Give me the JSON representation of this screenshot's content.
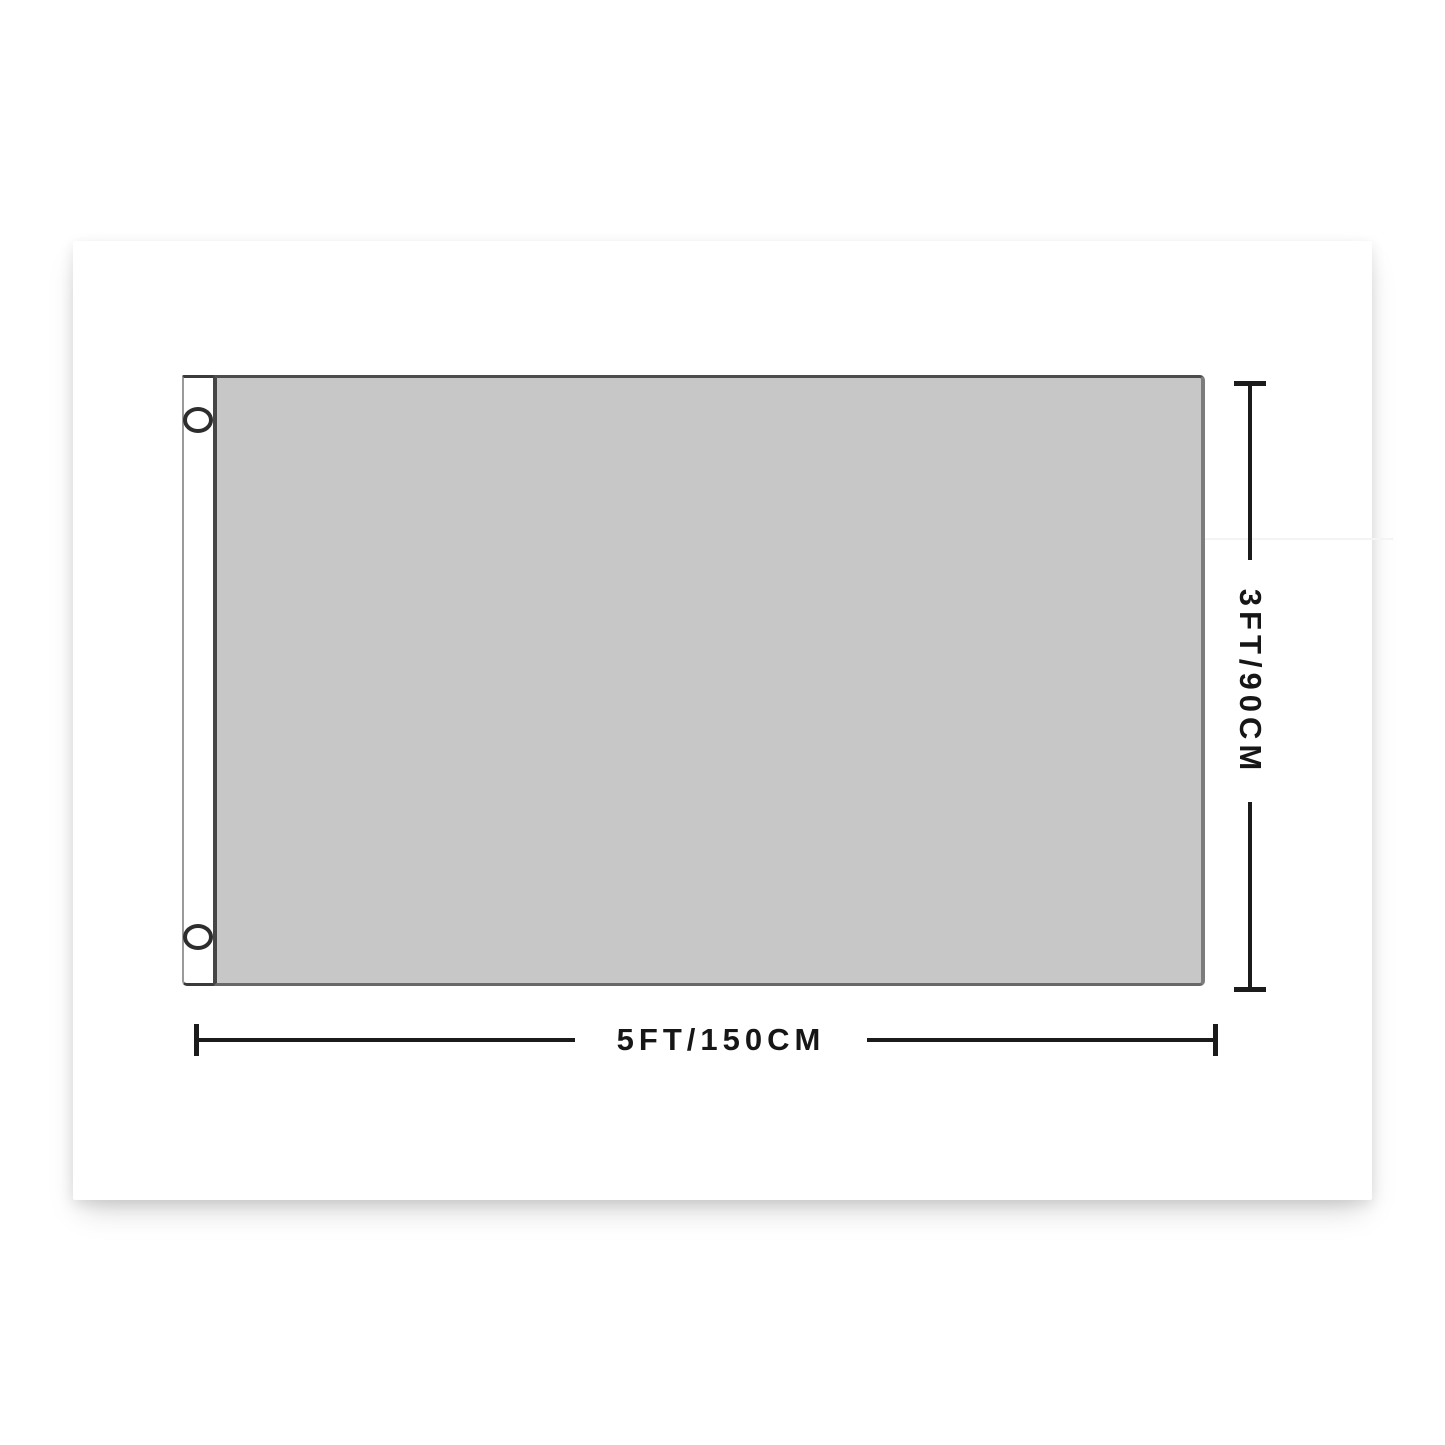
{
  "page": {
    "background_color": "#ffffff"
  },
  "product_card": {
    "type": "flag-size-diagram",
    "flag": {
      "fill_color": "#c6c7c6",
      "outline_color": "#4c4c4c",
      "sleeve_color": "#ffffff",
      "grommet_ring_color": "#2d2d2d",
      "grommets": [
        {
          "position": "top-left"
        },
        {
          "position": "bottom-left"
        }
      ]
    },
    "dimensions": {
      "line_color": "#1b1b1b",
      "width": {
        "label": "5FT/150CM"
      },
      "height": {
        "label": "3FT/90CM"
      }
    }
  }
}
